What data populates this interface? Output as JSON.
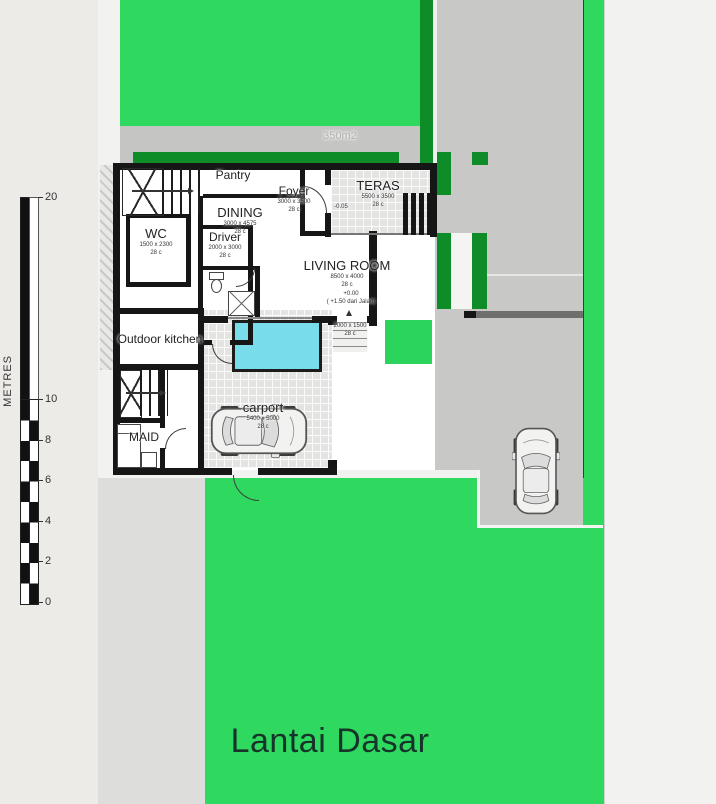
{
  "page": {
    "title": "Lantai Dasar"
  },
  "scale_bar": {
    "unit": "METRES",
    "ticks": [
      "20",
      "10",
      "8",
      "6",
      "4",
      "2",
      "0"
    ]
  },
  "site": {
    "area_label": "350m2"
  },
  "rooms": {
    "pantry": {
      "name": "Pantry"
    },
    "wc": {
      "name": "WC",
      "dims": "1500 x 2300",
      "code": "28 c"
    },
    "driver": {
      "name": "Driver",
      "dims": "2000 x 3000",
      "code": "28 c"
    },
    "dining": {
      "name": "DINING",
      "dims": "3000 x 4575",
      "code": "28 c"
    },
    "foyer": {
      "name": "Foyer",
      "dims": "3000 x 3500",
      "code": "28 c"
    },
    "teras": {
      "name": "TERAS",
      "dims": "5500 x 3500",
      "code": "28 c",
      "level": "-0.05"
    },
    "living": {
      "name": "LIVING ROOM",
      "dims": "8500 x 4000",
      "code": "28 c",
      "level": "+0.00",
      "level_note": "( +1.50 dari Jalan)"
    },
    "garden_steps": {
      "dims": "2000 x 1500",
      "code": "28 c"
    },
    "outdoor_kitchen": {
      "name": "Outdoor kitchen"
    },
    "maid": {
      "name": "MAID"
    },
    "carport": {
      "name": "carport",
      "dims": "5400 x 5000",
      "code": "28 c"
    }
  },
  "colors": {
    "lawn": "#2fd95f",
    "planter": "#0e8c27",
    "pool": "#78dcea",
    "paving": "#c8c8c7",
    "wall": "#161616"
  }
}
